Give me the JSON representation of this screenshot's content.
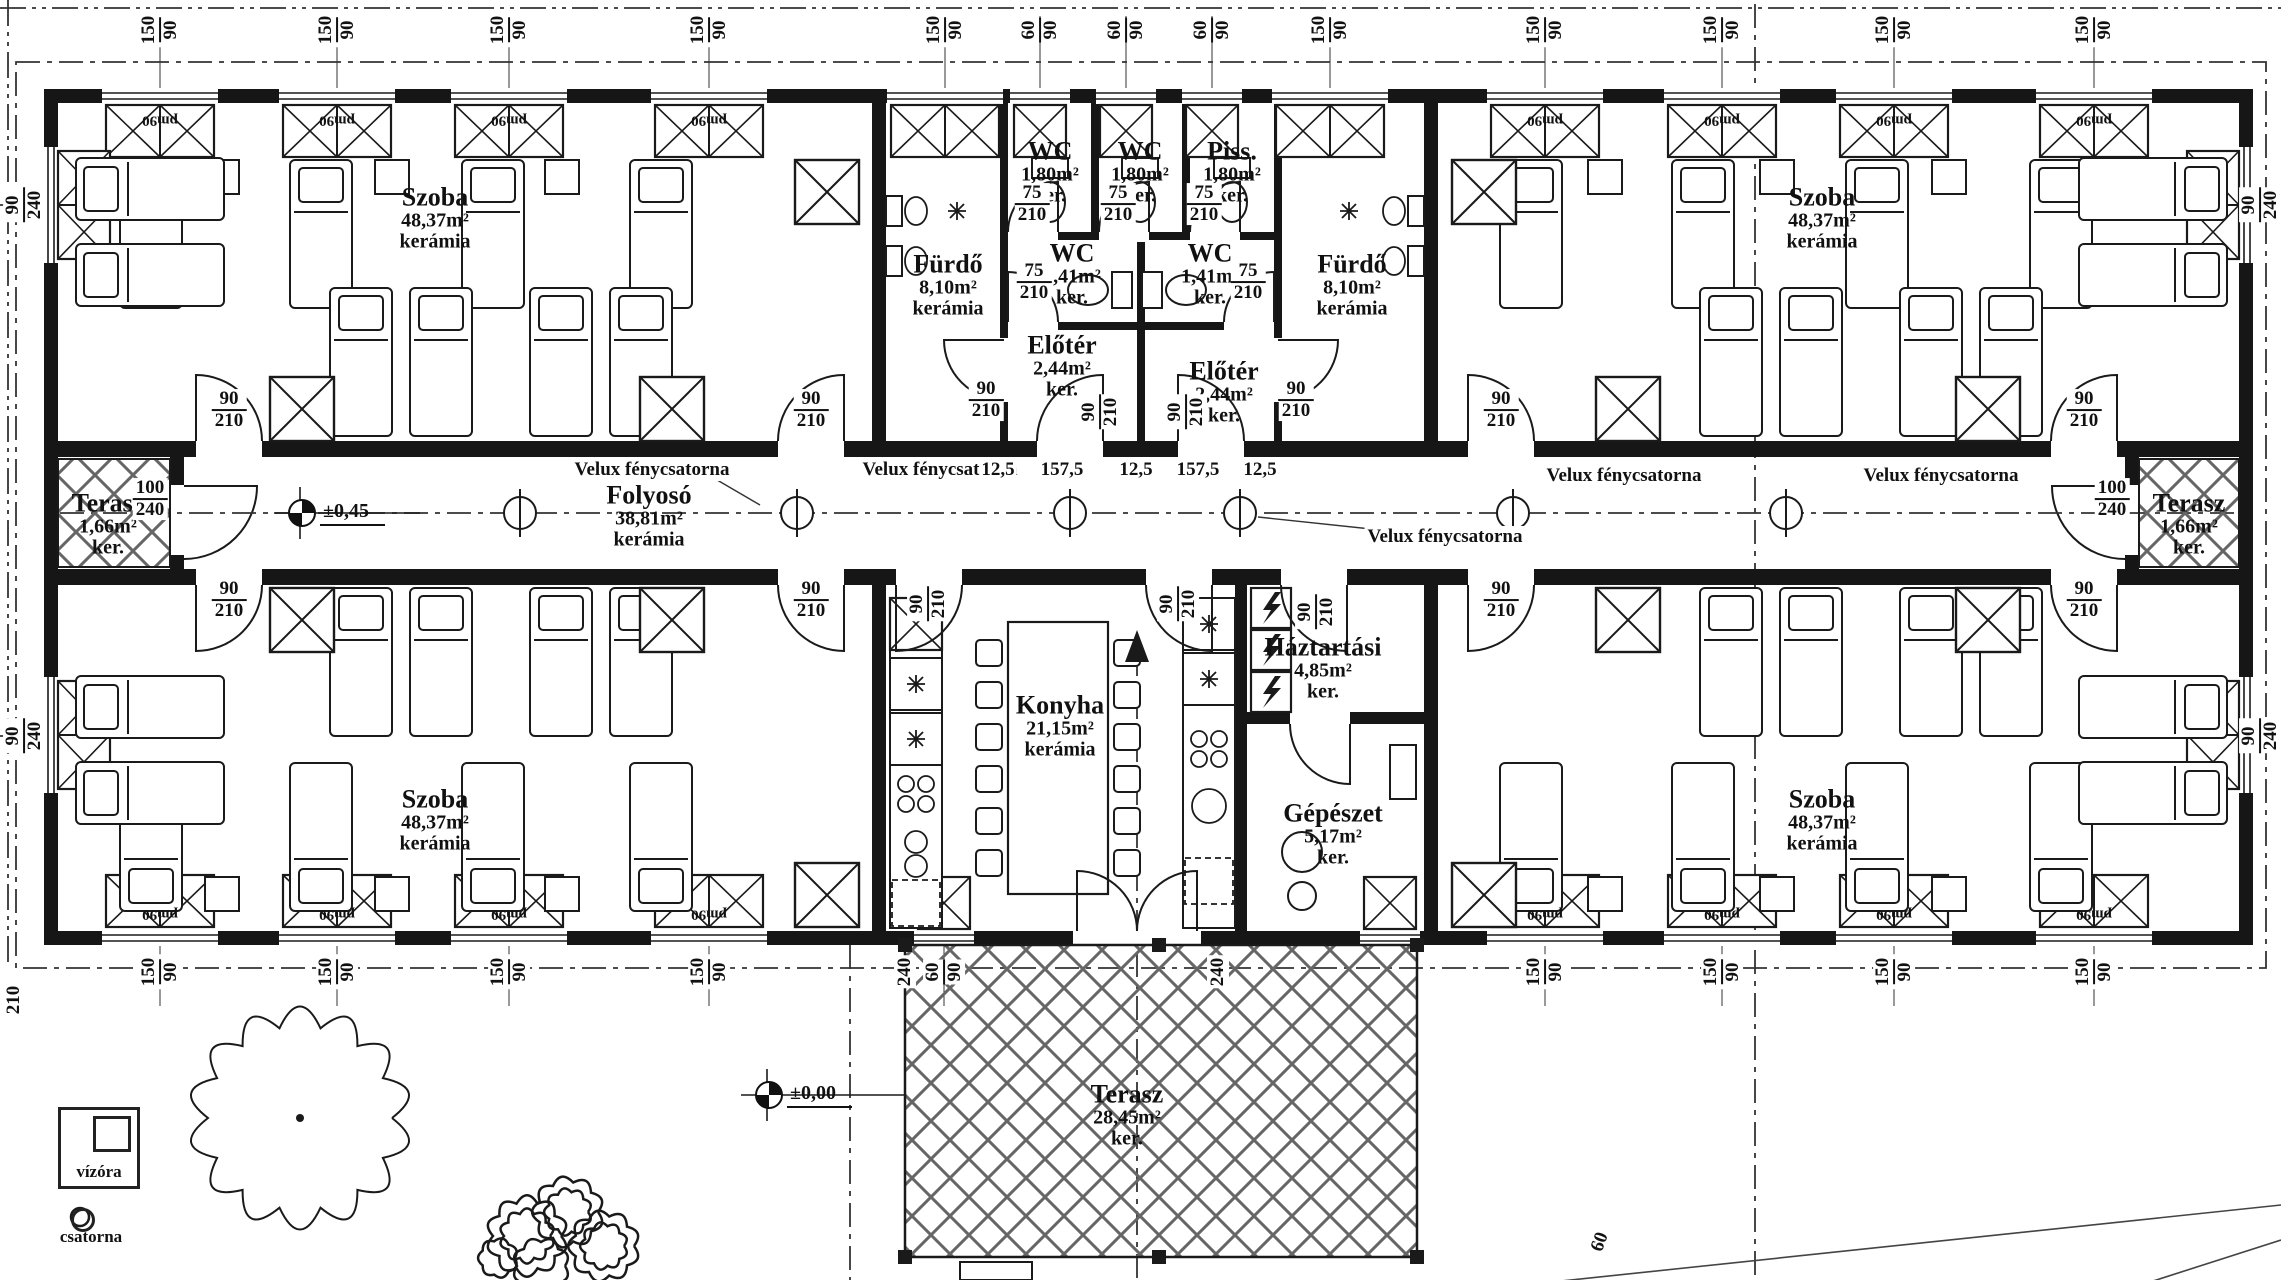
{
  "rooms": [
    {
      "n": "Szoba",
      "a": "48,37m²",
      "f": "kerámia",
      "x": 435,
      "y": 218
    },
    {
      "n": "Szoba",
      "a": "48,37m²",
      "f": "kerámia",
      "x": 1822,
      "y": 218
    },
    {
      "n": "Szoba",
      "a": "48,37m²",
      "f": "kerámia",
      "x": 435,
      "y": 820
    },
    {
      "n": "Szoba",
      "a": "48,37m²",
      "f": "kerámia",
      "x": 1822,
      "y": 820
    },
    {
      "n": "Fürdő",
      "a": "8,10m²",
      "f": "kerámia",
      "x": 948,
      "y": 285
    },
    {
      "n": "Fürdő",
      "a": "8,10m²",
      "f": "kerámia",
      "x": 1352,
      "y": 285
    },
    {
      "n": "WC",
      "a": "1,80m²",
      "f": "ker.",
      "x": 1050,
      "y": 172
    },
    {
      "n": "WC",
      "a": "1,80m²",
      "f": "ker.",
      "x": 1140,
      "y": 172
    },
    {
      "n": "Piss.",
      "a": "1,80m²",
      "f": "ker.",
      "x": 1232,
      "y": 172
    },
    {
      "n": "WC",
      "a": "1,41m²",
      "f": "ker.",
      "x": 1072,
      "y": 274
    },
    {
      "n": "WC",
      "a": "1,41m²",
      "f": "ker.",
      "x": 1210,
      "y": 274
    },
    {
      "n": "Előtér",
      "a": "2,44m²",
      "f": "ker.",
      "x": 1062,
      "y": 366
    },
    {
      "n": "Előtér",
      "a": "2,44m²",
      "f": "ker.",
      "x": 1224,
      "y": 392
    },
    {
      "n": "Folyosó",
      "a": "38,81m²",
      "f": "kerámia",
      "x": 649,
      "y": 516
    },
    {
      "n": "Terasz",
      "a": "1,66m²",
      "f": "ker.",
      "x": 108,
      "y": 524
    },
    {
      "n": "Terasz",
      "a": "1,66m²",
      "f": "ker.",
      "x": 2189,
      "y": 524
    },
    {
      "n": "Konyha",
      "a": "21,15m²",
      "f": "kerámia",
      "x": 1060,
      "y": 726
    },
    {
      "n": "Háztartási",
      "a": "4,85m²",
      "f": "ker.",
      "x": 1323,
      "y": 668
    },
    {
      "n": "Gépészet",
      "a": "5,17m²",
      "f": "ker.",
      "x": 1333,
      "y": 834
    },
    {
      "n": "Terasz",
      "a": "28,45m²",
      "f": "ker.",
      "x": 1127,
      "y": 1115
    }
  ],
  "velux": [
    {
      "t": "Velux fénycsatorna",
      "x": 652,
      "y": 470
    },
    {
      "t": "Velux fénycsatorna",
      "x": 940,
      "y": 470
    },
    {
      "t": "Velux fénycsatorna",
      "x": 1624,
      "y": 476
    },
    {
      "t": "Velux fénycsatorna",
      "x": 1941,
      "y": 476
    },
    {
      "t": "Velux fénycsatorna",
      "x": 1445,
      "y": 537
    }
  ],
  "levels": [
    {
      "t": "±0,45",
      "x": 288,
      "y": 513
    },
    {
      "t": "±0,00",
      "x": 755,
      "y": 1095
    }
  ],
  "dims": [
    {
      "t": "12,5",
      "x": 998,
      "y": 470
    },
    {
      "t": "157,5",
      "x": 1062,
      "y": 470
    },
    {
      "t": "12,5",
      "x": 1136,
      "y": 470
    },
    {
      "t": "157,5",
      "x": 1198,
      "y": 470
    },
    {
      "t": "12,5",
      "x": 1260,
      "y": 470
    },
    {
      "t": "240",
      "x": 1218,
      "y": 972,
      "r": -90
    },
    {
      "t": "240",
      "x": 905,
      "y": 972,
      "r": -90
    },
    {
      "t": "60",
      "x": 1600,
      "y": 1242,
      "r": -70
    },
    {
      "t": "210",
      "x": 14,
      "y": 1000,
      "r": -90
    }
  ],
  "pairs": [
    {
      "a": "150",
      "b": "90",
      "x": 160,
      "y": 30,
      "r": -90
    },
    {
      "a": "150",
      "b": "90",
      "x": 337,
      "y": 30,
      "r": -90
    },
    {
      "a": "150",
      "b": "90",
      "x": 509,
      "y": 30,
      "r": -90
    },
    {
      "a": "150",
      "b": "90",
      "x": 709,
      "y": 30,
      "r": -90
    },
    {
      "a": "150",
      "b": "90",
      "x": 945,
      "y": 30,
      "r": -90
    },
    {
      "a": "60",
      "b": "90",
      "x": 1040,
      "y": 30,
      "r": -90
    },
    {
      "a": "60",
      "b": "90",
      "x": 1126,
      "y": 30,
      "r": -90
    },
    {
      "a": "60",
      "b": "90",
      "x": 1212,
      "y": 30,
      "r": -90
    },
    {
      "a": "150",
      "b": "90",
      "x": 1330,
      "y": 30,
      "r": -90
    },
    {
      "a": "150",
      "b": "90",
      "x": 1545,
      "y": 30,
      "r": -90
    },
    {
      "a": "150",
      "b": "90",
      "x": 1722,
      "y": 30,
      "r": -90
    },
    {
      "a": "150",
      "b": "90",
      "x": 1894,
      "y": 30,
      "r": -90
    },
    {
      "a": "150",
      "b": "90",
      "x": 2094,
      "y": 30,
      "r": -90
    },
    {
      "a": "150",
      "b": "90",
      "x": 160,
      "y": 972,
      "r": -90
    },
    {
      "a": "150",
      "b": "90",
      "x": 337,
      "y": 972,
      "r": -90
    },
    {
      "a": "150",
      "b": "90",
      "x": 509,
      "y": 972,
      "r": -90
    },
    {
      "a": "150",
      "b": "90",
      "x": 709,
      "y": 972,
      "r": -90
    },
    {
      "a": "60",
      "b": "90",
      "x": 944,
      "y": 972,
      "r": -90
    },
    {
      "a": "150",
      "b": "90",
      "x": 1545,
      "y": 972,
      "r": -90
    },
    {
      "a": "150",
      "b": "90",
      "x": 1722,
      "y": 972,
      "r": -90
    },
    {
      "a": "150",
      "b": "90",
      "x": 1894,
      "y": 972,
      "r": -90
    },
    {
      "a": "150",
      "b": "90",
      "x": 2094,
      "y": 972,
      "r": -90
    },
    {
      "a": "90",
      "b": "240",
      "x": 24,
      "y": 205,
      "r": -90
    },
    {
      "a": "90",
      "b": "240",
      "x": 24,
      "y": 736,
      "r": -90
    },
    {
      "a": "90",
      "b": "240",
      "x": 2260,
      "y": 205,
      "r": -90
    },
    {
      "a": "90",
      "b": "240",
      "x": 2260,
      "y": 736,
      "r": -90
    },
    {
      "a": "100",
      "b": "240",
      "x": 150,
      "y": 499
    },
    {
      "a": "100",
      "b": "240",
      "x": 2112,
      "y": 499
    },
    {
      "a": "90",
      "b": "210",
      "x": 229,
      "y": 410
    },
    {
      "a": "90",
      "b": "210",
      "x": 811,
      "y": 410
    },
    {
      "a": "90",
      "b": "210",
      "x": 1501,
      "y": 410
    },
    {
      "a": "90",
      "b": "210",
      "x": 2084,
      "y": 410
    },
    {
      "a": "90",
      "b": "210",
      "x": 229,
      "y": 600
    },
    {
      "a": "90",
      "b": "210",
      "x": 811,
      "y": 600
    },
    {
      "a": "90",
      "b": "210",
      "x": 1501,
      "y": 600
    },
    {
      "a": "90",
      "b": "210",
      "x": 2084,
      "y": 600
    },
    {
      "a": "75",
      "b": "210",
      "x": 1032,
      "y": 204
    },
    {
      "a": "75",
      "b": "210",
      "x": 1118,
      "y": 204
    },
    {
      "a": "75",
      "b": "210",
      "x": 1204,
      "y": 204
    },
    {
      "a": "75",
      "b": "210",
      "x": 1034,
      "y": 282
    },
    {
      "a": "75",
      "b": "210",
      "x": 1248,
      "y": 282
    },
    {
      "a": "90",
      "b": "210",
      "x": 986,
      "y": 400
    },
    {
      "a": "90",
      "b": "210",
      "x": 1296,
      "y": 400
    },
    {
      "a": "90",
      "b": "210",
      "x": 1100,
      "y": 412,
      "r": -90
    },
    {
      "a": "90",
      "b": "210",
      "x": 1186,
      "y": 412,
      "r": -90
    },
    {
      "a": "90",
      "b": "210",
      "x": 928,
      "y": 604,
      "r": -90
    },
    {
      "a": "90",
      "b": "210",
      "x": 1178,
      "y": 604,
      "r": -90
    },
    {
      "a": "90",
      "b": "210",
      "x": 1316,
      "y": 612,
      "r": -90
    }
  ],
  "tags": [
    {
      "t": "pm90",
      "x": 160,
      "y": 120,
      "r": 180
    },
    {
      "t": "pm90",
      "x": 337,
      "y": 120,
      "r": 180
    },
    {
      "t": "pm90",
      "x": 509,
      "y": 120,
      "r": 180
    },
    {
      "t": "pm90",
      "x": 709,
      "y": 120,
      "r": 180
    },
    {
      "t": "pm90",
      "x": 1545,
      "y": 120,
      "r": 180
    },
    {
      "t": "pm90",
      "x": 1722,
      "y": 120,
      "r": 180
    },
    {
      "t": "pm90",
      "x": 1894,
      "y": 120,
      "r": 180
    },
    {
      "t": "pm90",
      "x": 2094,
      "y": 120,
      "r": 180
    },
    {
      "t": "pm90",
      "x": 160,
      "y": 914,
      "r": 180
    },
    {
      "t": "pm90",
      "x": 337,
      "y": 914,
      "r": 180
    },
    {
      "t": "pm90",
      "x": 509,
      "y": 914,
      "r": 180
    },
    {
      "t": "pm90",
      "x": 709,
      "y": 914,
      "r": 180
    },
    {
      "t": "pm90",
      "x": 1545,
      "y": 914,
      "r": 180
    },
    {
      "t": "pm90",
      "x": 1722,
      "y": 914,
      "r": 180
    },
    {
      "t": "pm90",
      "x": 1894,
      "y": 914,
      "r": 180
    },
    {
      "t": "pm90",
      "x": 2094,
      "y": 914,
      "r": 180
    }
  ],
  "legend": {
    "vizora": "vízóra",
    "csatorna": "csatorna"
  }
}
